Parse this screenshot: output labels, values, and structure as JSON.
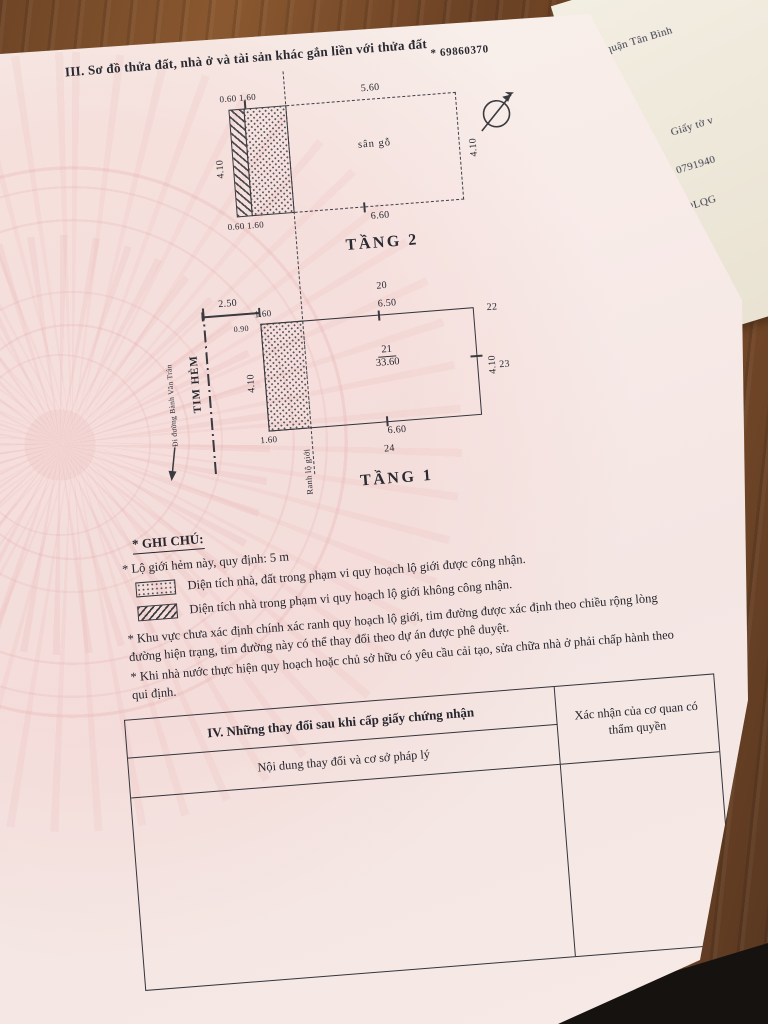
{
  "doc": {
    "section_title": "III. Sơ đồ thửa đất, nhà ở và tài sản khác gắn liền với thửa đất",
    "cert_number": "* 69860370"
  },
  "floor2": {
    "label": "TẦNG 2",
    "room": "sân gỗ",
    "dims": {
      "top_left": "0.60 1.60",
      "top": "5.60",
      "left": "4.10",
      "right": "4.10",
      "bottom": "6.60",
      "bottom_left": "0.60 1.60"
    }
  },
  "floor1": {
    "label": "TẦNG 1",
    "parcel": "21",
    "area": "33.60",
    "dims": {
      "alley_half": "2.50",
      "top_strip": "1.60",
      "top": "6.50",
      "left": "4.10",
      "left_small": "0.90",
      "right": "4.10",
      "bottom": "6.60",
      "bottom_strip": "1.60"
    },
    "points": {
      "p20": "20",
      "p22": "22",
      "p23": "23",
      "p24": "24"
    },
    "alley_centerline": "TIM HẺM",
    "street_direction": "Đi đường Bành Văn Trân",
    "boundary_line": "Ranh lộ giới"
  },
  "notes": {
    "title": "* GHI CHÚ:",
    "line1": "* Lộ giới hẻm này, quy định: 5 m",
    "legend": [
      {
        "swatch": "dotted-swatch",
        "text": "Diện tích nhà, đất trong phạm vi quy hoạch lộ giới được công nhận."
      },
      {
        "swatch": "hatched-swatch",
        "text": "Diện tích nhà trong phạm vi quy hoạch lộ giới không công nhận."
      }
    ],
    "para1": "* Khu vực chưa xác định chính xác ranh quy hoạch lộ giới, tim đường được xác định theo chiều rộng lòng đường hiện trạng, tim đường này có thể thay đổi theo dự án được phê duyệt.",
    "para2": "* Khi nhà nước thực hiện quy hoạch hoặc chủ sở hữu có yêu cầu cải tạo, sửa chữa nhà ở phải chấp hành theo qui định."
  },
  "table": {
    "title": "IV. Những thay đổi sau khi cấp giấy chứng nhận",
    "col_left": "Nội dung thay đổi và cơ sở pháp lý",
    "col_right": "Xác nhận của cơ quan có thẩm quyền"
  },
  "bg_doc": {
    "line1": "quận Tân Bình",
    "line2": "Giấy tờ v",
    "line3": "0791940",
    "line4": "DLQG"
  },
  "icons": {
    "north_arrow": "north-arrow-icon"
  },
  "colors": {
    "paper_pink": "#f7ece9",
    "desk_wood": "#744a2a",
    "ink": "#26262e",
    "emblem_pink": "#e0a0a0"
  }
}
